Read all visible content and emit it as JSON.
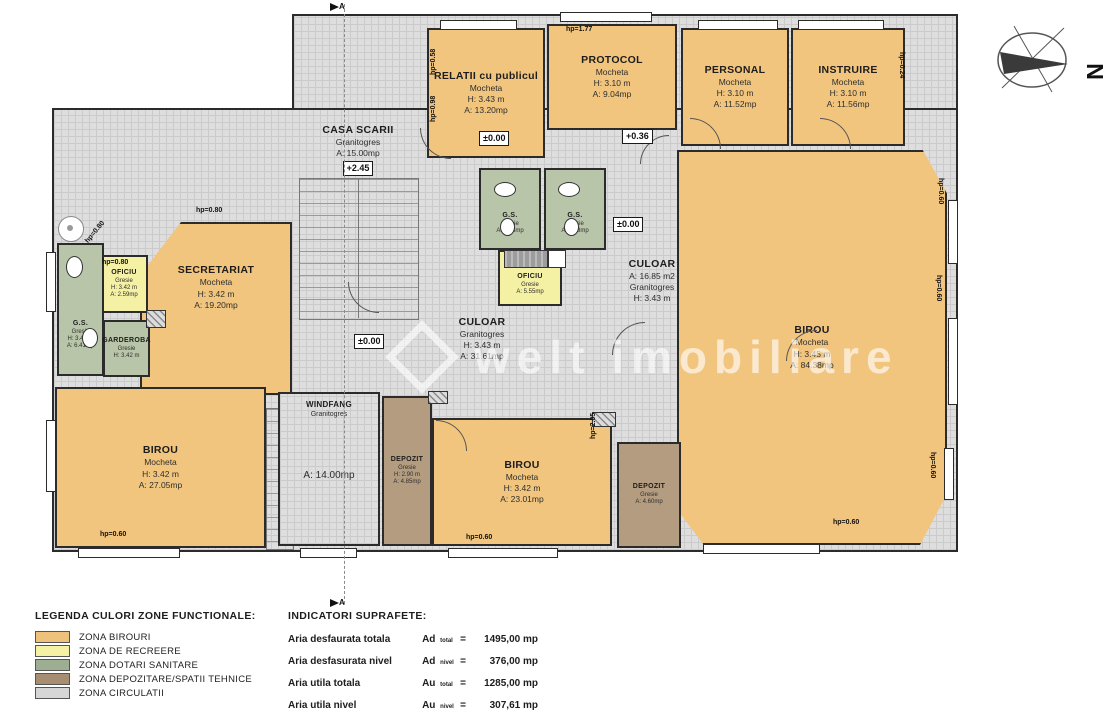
{
  "plan": {
    "rooms": {
      "relatii": {
        "name": "RELATII cu publicul",
        "line1": "Mocheta",
        "line2": "H: 3.43 m",
        "line3": "A: 13.20mp"
      },
      "protocol": {
        "name": "PROTOCOL",
        "line1": "Mocheta",
        "line2": "H: 3.10 m",
        "line3": "A: 9.04mp"
      },
      "personal": {
        "name": "PERSONAL",
        "line1": "Mocheta",
        "line2": "H: 3.10 m",
        "line3": "A: 11.52mp"
      },
      "instruire": {
        "name": "INSTRUIRE",
        "line1": "Mocheta",
        "line2": "H: 3.10 m",
        "line3": "A: 11.56mp"
      },
      "casa_scarii": {
        "name": "CASA SCARII",
        "line1": "Granitogres",
        "line2": "A: 15.00mp"
      },
      "birou_mare": {
        "name": "BIROU",
        "line1": "Mocheta",
        "line2": "H: 3.45 m",
        "line3": "A: 84.38mp"
      },
      "secretariat": {
        "name": "SECRETARIAT",
        "line1": "Mocheta",
        "line2": "H: 3.42 m",
        "line3": "A: 19.20mp"
      },
      "oficiu_stanga": {
        "name": "OFICIU",
        "line1": "Gresie",
        "line2": "H: 3.42 m",
        "line3": "A: 2.59mp"
      },
      "gs_stanga": {
        "name": "G.S.",
        "line1": "Gresie",
        "line2": "H: 3.42 m",
        "line3": "A: 6.41mp"
      },
      "garderoba": {
        "name": "GARDEROBA",
        "line1": "Gresie",
        "line2": "H: 3.42 m"
      },
      "gs_centru_1": {
        "name": "G.S.",
        "line1": "Gresie",
        "line2": "A: 3.58mp"
      },
      "gs_centru_2": {
        "name": "G.S.",
        "line1": "Gresie",
        "line2": "A: 3.58mp"
      },
      "oficiu_centru": {
        "name": "OFICIU",
        "line1": "Gresie",
        "line2": "A: 5.55mp"
      },
      "culoar_dreapta": {
        "name": "CULOAR",
        "line1": "A: 16.85 m2",
        "line2": "Granitogres",
        "line3": "H: 3.43 m"
      },
      "culoar_centru": {
        "name": "CULOAR",
        "line1": "Granitogres",
        "line2": "H: 3.43 m",
        "line3": "A: 31.61mp"
      },
      "windfang": {
        "name": "WINDFANG",
        "line1": "Granitogres",
        "area": "A: 14.00mp"
      },
      "depozit_stanga": {
        "name": "DEPOZIT",
        "line1": "Gresie",
        "line2": "H: 2.90 m",
        "line3": "A: 4.85mp"
      },
      "birou_centru": {
        "name": "BIROU",
        "line1": "Mocheta",
        "line2": "H: 3.42 m",
        "line3": "A: 23.01mp"
      },
      "depozit_dreapta": {
        "name": "DEPOZIT",
        "line1": "Gresie",
        "line2": "A: 4.60mp"
      },
      "birou_stanga": {
        "name": "BIROU",
        "line1": "Mocheta",
        "line2": "H: 3.42 m",
        "line3": "A: 27.05mp"
      }
    },
    "markers": {
      "lvl_relatii": "±0.00",
      "lvl_hol": "+0.36",
      "lvl_culoar_dreapta": "±0.00",
      "lvl_culoar_centru": "±0.00",
      "lvl_scara": "+2.45",
      "hp_protocol": "hp=1.77",
      "hp_secretariat": "hp=0.80",
      "hp_oficiu": "hp=0.80",
      "hp_chamfer": "hp=0.80",
      "hp_relatii_sus": "hp=0.58",
      "hp_relatii_jos": "hp=0.98",
      "hp_instruire": "hp=0.24",
      "hp_dr1": "hp=0.60",
      "hp_dr2": "hp=0.60",
      "hp_dr3": "hp=0.60",
      "hp_birou_stanga": "hp=0.60",
      "hp_birou_centru": "hp=0.60",
      "hp_birou_mare": "hp=0.60",
      "hp_perete": "hp=2.05"
    },
    "watermark": "welt imobiliare",
    "compass_label": "N",
    "section_label": "A"
  },
  "legend": {
    "title": "LEGENDA CULORI ZONE FUNCTIONALE:",
    "items": [
      {
        "label": "ZONA BIROURI",
        "color": "#efc27b"
      },
      {
        "label": "ZONA DE RECREERE",
        "color": "#f6f2a5"
      },
      {
        "label": "ZONA DOTARI SANITARE",
        "color": "#9eae93"
      },
      {
        "label": "ZONA DEPOZITARE/SPATII TEHNICE",
        "color": "#a78e72"
      },
      {
        "label": "ZONA CIRCULATII",
        "color": "#d6d6d6"
      }
    ]
  },
  "indicators": {
    "title": "INDICATORI SUPRAFETE:",
    "rows": [
      {
        "label": "Aria desfaurata totala",
        "sym": "Ad",
        "sub": "total",
        "eq": "=",
        "value": "1495,00 mp"
      },
      {
        "label": "Aria desfasurata nivel",
        "sym": "Ad",
        "sub": "nivel",
        "eq": "=",
        "value": "376,00 mp"
      },
      {
        "label": "Aria utila totala",
        "sym": "Au",
        "sub": "total",
        "eq": "=",
        "value": "1285,00 mp"
      },
      {
        "label": "Aria utila nivel",
        "sym": "Au",
        "sub": "nivel",
        "eq": "=",
        "value": "307,61 mp"
      }
    ]
  },
  "colors": {
    "zona_birouri": "#f2c57e",
    "zona_recreere": "#f5f1a4",
    "zona_sanitare": "#b9c5a8",
    "zona_depozitare": "#b49c80",
    "zona_circulatii": "#dedede",
    "wall": "#2b2b2b"
  }
}
